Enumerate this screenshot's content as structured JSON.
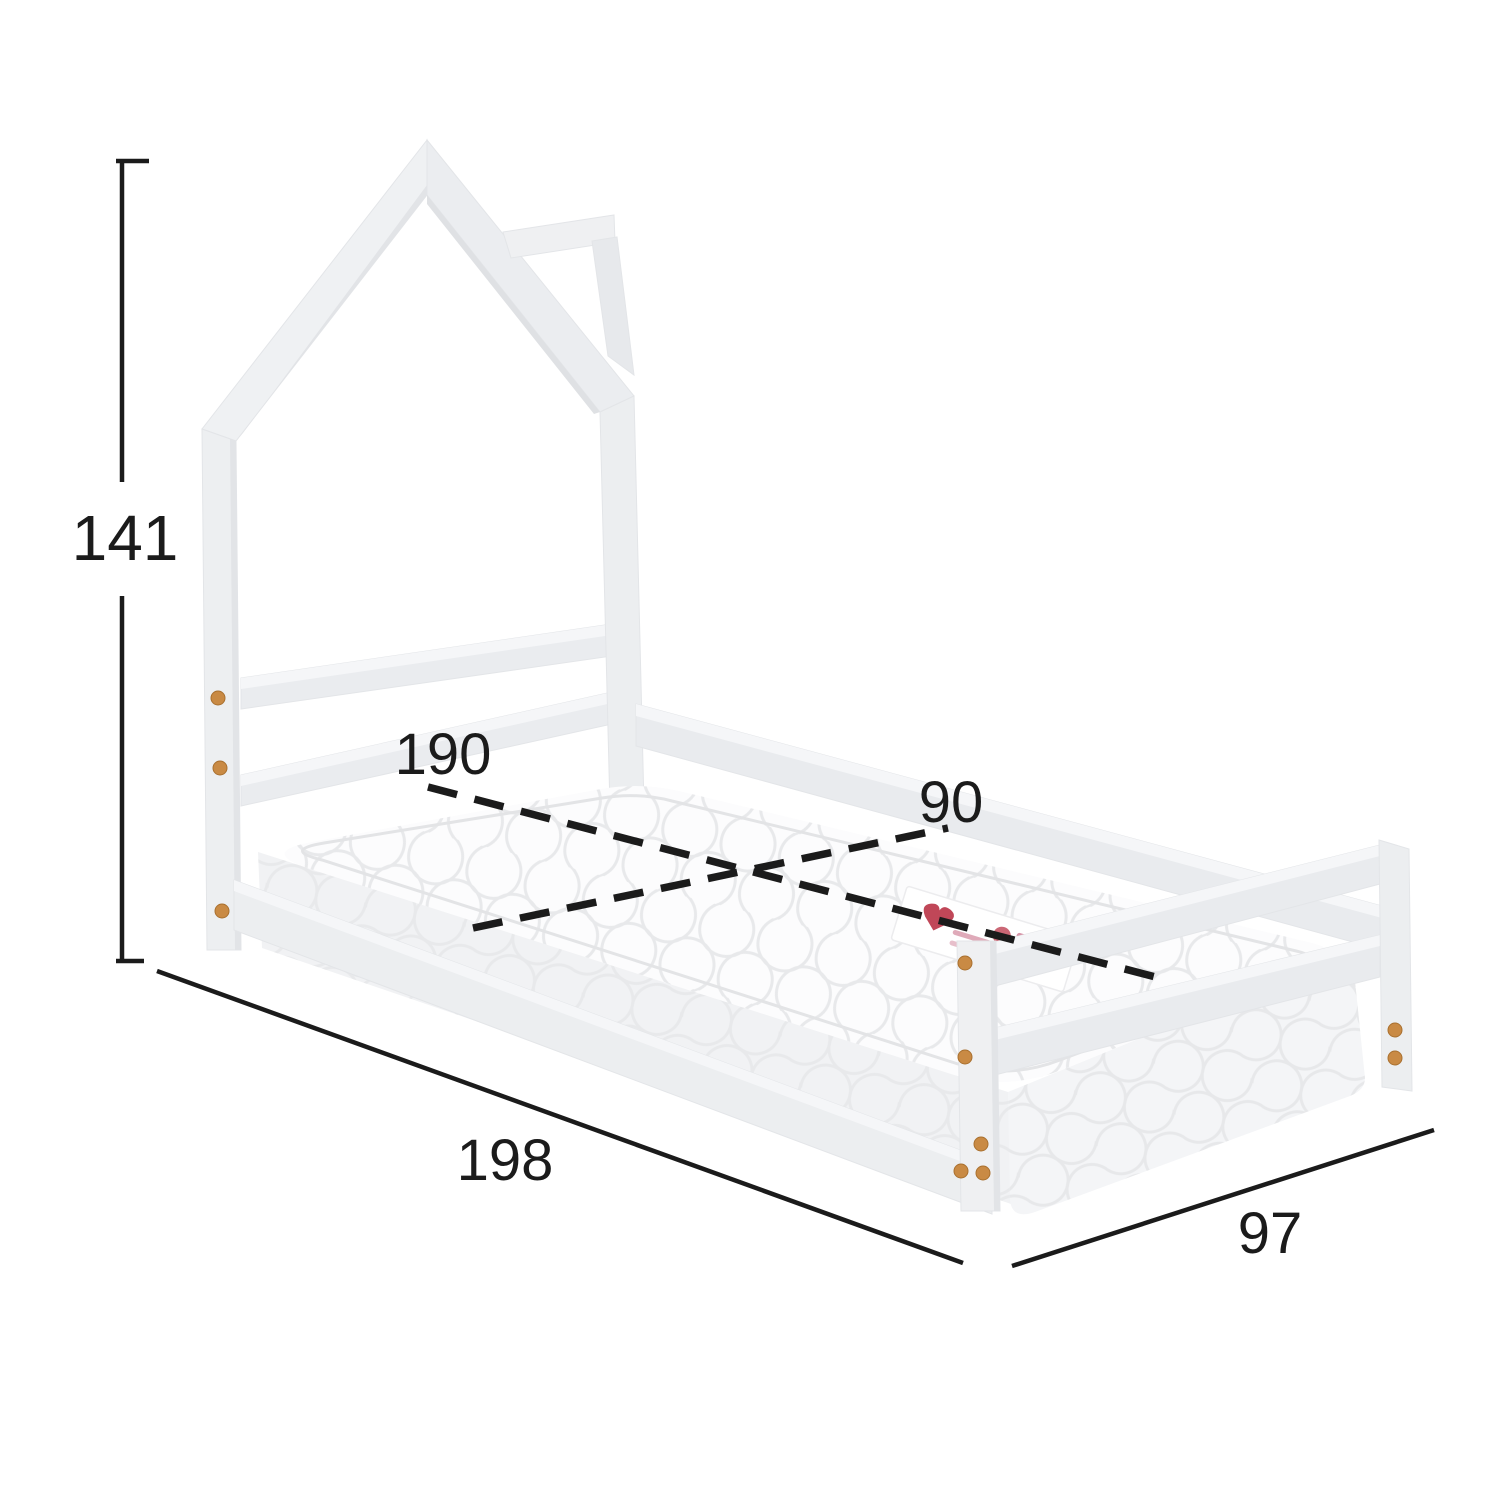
{
  "dimensions": {
    "height": "141",
    "mattress_length": "190",
    "mattress_width": "90",
    "frame_length": "198",
    "frame_width": "97"
  },
  "colors": {
    "background": "#ffffff",
    "dimension_line": "#1b1b1b",
    "frame_top_face": "#f5f6f8",
    "frame_face": "#edeff1",
    "frame_shade": "#e0e2e5",
    "mattress": "#fcfcfd",
    "quilt_line": "#e8e9eb",
    "dowel": "#c98a44",
    "tag_red": "#b5273b",
    "tag_pink": "#d795a8"
  }
}
